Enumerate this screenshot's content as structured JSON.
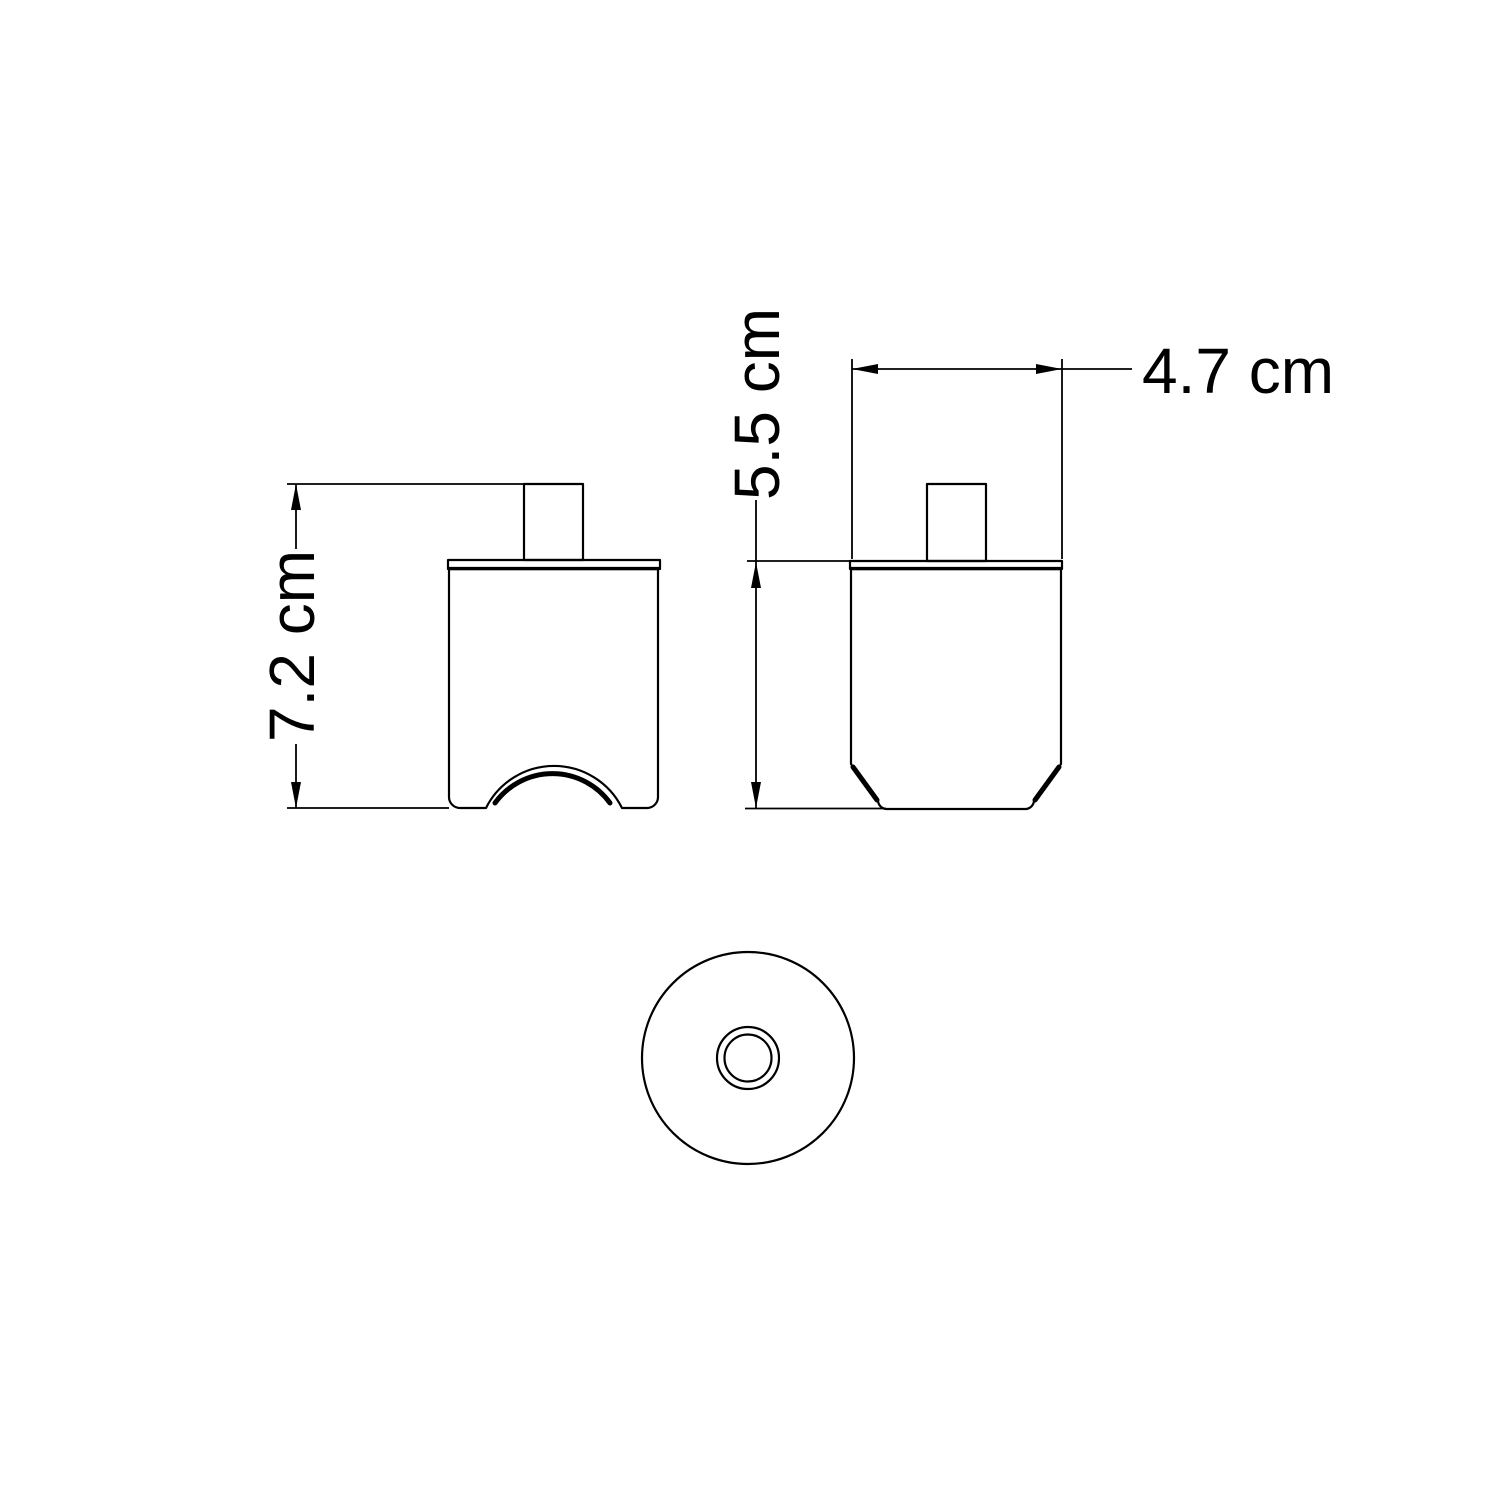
{
  "drawing": {
    "background_color": "#ffffff",
    "line_color": "#000000",
    "views": {
      "front": {
        "height_dimension_label": "7.2 cm"
      },
      "side": {
        "height_dimension_label": "5.5 cm",
        "width_dimension_label": "4.7 cm"
      },
      "bottom": {}
    }
  }
}
